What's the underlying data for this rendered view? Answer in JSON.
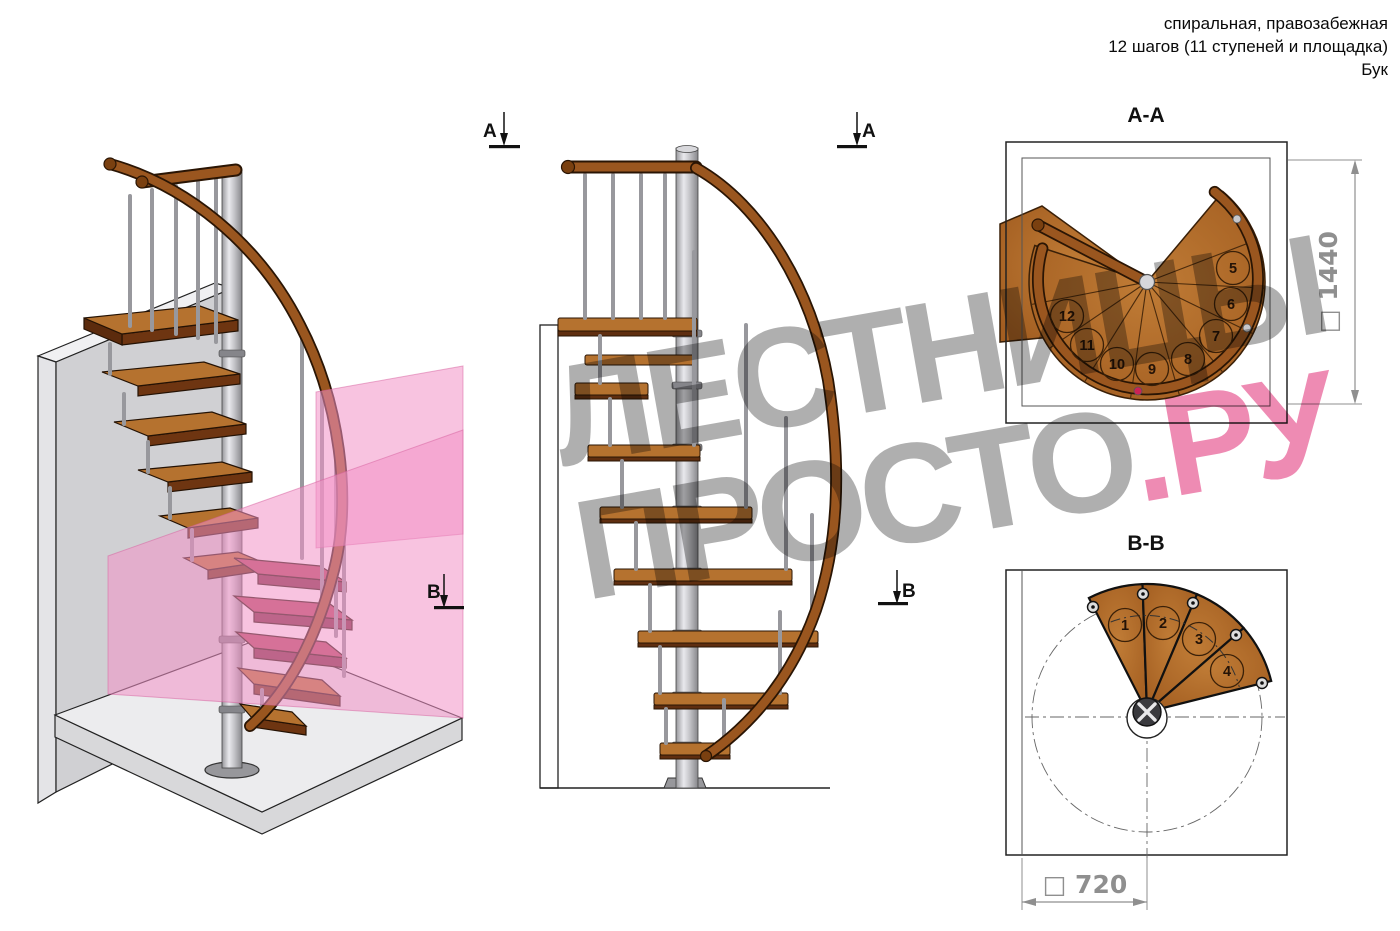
{
  "header": {
    "line1": "спиральная, правозабежная",
    "line2": "12 шагов (11 ступеней и площадка)",
    "line3": "Бук"
  },
  "watermark": {
    "word1": "ЛЕСТНИЦЫ",
    "word2": "ПРОСТО",
    "suffix": ".РУ"
  },
  "section_markers": {
    "a": "А",
    "b": "В"
  },
  "plan_aa": {
    "title": "А-А",
    "dimension": "□ 1440",
    "step_numbers": [
      "5",
      "6",
      "7",
      "8",
      "9",
      "10",
      "11",
      "12"
    ]
  },
  "plan_bb": {
    "title": "В-В",
    "dimension": "□ 720",
    "step_numbers": [
      "1",
      "2",
      "3",
      "4"
    ]
  },
  "colors": {
    "wood": "#b06a28",
    "wood_dark": "#6b3310",
    "handrail": "#8a4a1c",
    "metal": "#c9c9cd",
    "wall": "#d0d0d3",
    "floor": "#ececee",
    "section_plane_pink": "#f2a3cc",
    "section_step_crimson": "#b34b60",
    "watermark_gray": "#a2a2a2",
    "watermark_pink": "#ee86ab",
    "dimension_gray": "#8f8f8f"
  }
}
